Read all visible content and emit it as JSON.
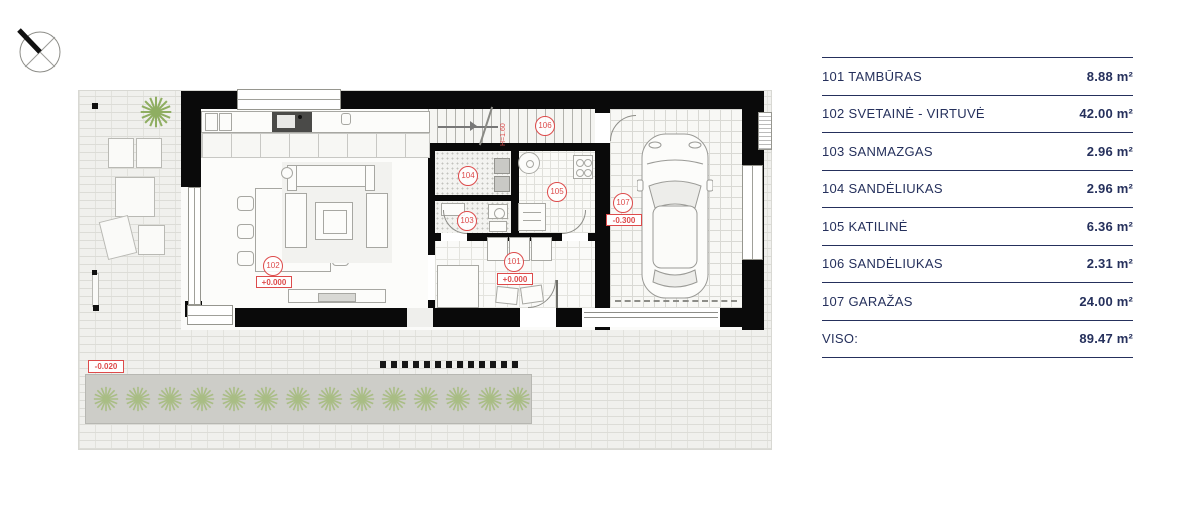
{
  "colors": {
    "navy": "#25305c",
    "red": "#dd4b4b",
    "wall": "#0a0a0a",
    "plant_green": "#a9bd85",
    "tree_green": "#8fae62"
  },
  "plan": {
    "rooms": [
      {
        "num": "101",
        "elev": "+0.000"
      },
      {
        "num": "102",
        "elev": "+0.000"
      },
      {
        "num": "103"
      },
      {
        "num": "104"
      },
      {
        "num": "105"
      },
      {
        "num": "106"
      },
      {
        "num": "107",
        "elev": "-0.300"
      }
    ],
    "site_elevation": "-0.020",
    "stair_note": "H=1.60"
  },
  "legend": {
    "rows": [
      {
        "label": "101 TAMBŪRAS",
        "area": "8.88 m²"
      },
      {
        "label": "102 SVETAINĖ - VIRTUVĖ",
        "area": "42.00 m²"
      },
      {
        "label": "103 SANMAZGAS",
        "area": "2.96 m²"
      },
      {
        "label": "104 SANDĖLIUKAS",
        "area": "2.96 m²"
      },
      {
        "label": "105 KATILINĖ",
        "area": "6.36 m²"
      },
      {
        "label": "106 SANDĖLIUKAS",
        "area": "2.31 m²"
      },
      {
        "label": "107 GARAŽAS",
        "area": "24.00 m²"
      },
      {
        "label": "VISO:",
        "area": "89.47 m²"
      }
    ]
  }
}
